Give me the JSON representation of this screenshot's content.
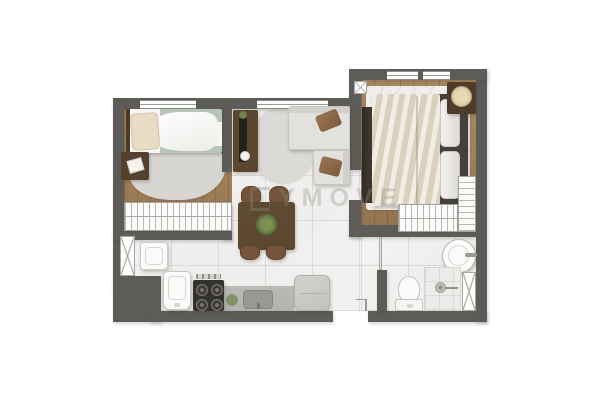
{
  "image_type": "apartment floor plan, top-down 3D render",
  "watermark": {
    "text": "YMOVE",
    "logo": "square-bracket-logo",
    "color": "#8f8d89"
  },
  "palette": {
    "wall": "#5e5c59",
    "floor_marble": "#f3f2f0",
    "wood_a": "#a3825d",
    "wood_b": "#91724f",
    "rug": "#d8d6d2",
    "sofa": "#e3e1dd",
    "dark_wood": "#5b462f",
    "cream": "#e9e1d2",
    "sage": "#b7c4ba",
    "counter": "#b4b2af",
    "stove": "#33312e",
    "fixture": "#fbfbfa"
  },
  "rooms": [
    {
      "name": "bedroom-small",
      "floor": "wood",
      "furniture": [
        "single-bed",
        "pillow",
        "sage-blanket",
        "nightstand",
        "area-rug",
        "slatted-wardrobe"
      ]
    },
    {
      "name": "living-dining",
      "floor": "marble",
      "furniture": [
        "tv-console",
        "tv",
        "plant",
        "round-rug",
        "corner-sofa",
        "two-brown-cushions",
        "dining-table",
        "table-plant",
        "four-chairs"
      ]
    },
    {
      "name": "kitchen",
      "floor": "marble",
      "furniture": [
        "utility-basin",
        "white-refrigerator",
        "stove-4-burners",
        "countertop-with-sink",
        "herb-plant",
        "gray-appliance"
      ]
    },
    {
      "name": "bedroom-master",
      "floor": "wood",
      "furniture": [
        "double-bed",
        "two-pillows",
        "nightstand-with-lamp",
        "dark-wardrobe",
        "slatted-closet-L"
      ]
    },
    {
      "name": "bathroom",
      "floor": "marble",
      "furniture": [
        "round-washbasin",
        "toilet",
        "shower-with-drain"
      ]
    },
    {
      "name": "hallway",
      "floor": "marble",
      "furniture": []
    }
  ],
  "openings": {
    "windows": [
      "bedroom-small-top",
      "living-top",
      "bedroom-master-top-left",
      "bedroom-master-top-right"
    ],
    "doors": [
      "entry-bottom",
      "bathroom-door",
      "left-wall-door-x",
      "bathroom-right-door-x"
    ],
    "column_marker": "x-box-top-of-master-bedroom"
  }
}
